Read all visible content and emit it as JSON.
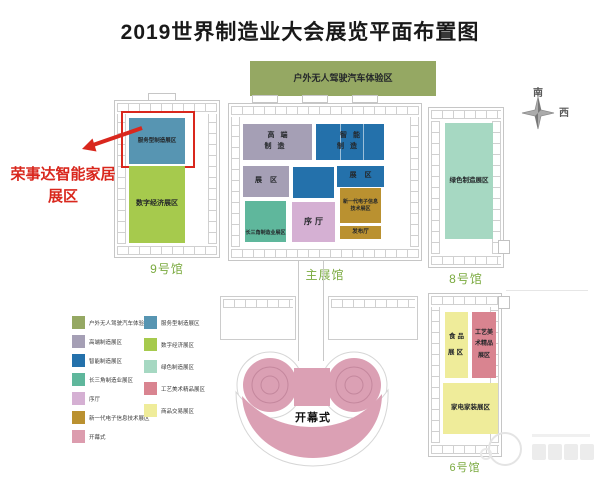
{
  "title": "2019世界制造业大会展览平面布置图",
  "compass": {
    "south": "南",
    "west": "西"
  },
  "callout": {
    "line1": "荣事达智能家居",
    "line2": "展区",
    "color": "#d9271d"
  },
  "halls": {
    "hall9": "9号馆",
    "main": "主展馆",
    "hall8": "8号馆",
    "hall6": "6号馆"
  },
  "zones": {
    "outdoor": {
      "label": "户外无人驾驶汽车体验区",
      "color": "#95a863"
    },
    "service": {
      "label": "服务型制造展区",
      "color": "#5795b2"
    },
    "digital": {
      "label": "数字经济展区",
      "color": "#a6ca4d"
    },
    "highend": {
      "label": "高端\n制造",
      "color": "#a59fb5"
    },
    "highend_area": {
      "label": "展区",
      "color": "#a59fb5"
    },
    "smart": {
      "label": "智能\n制造",
      "color": "#2471ab"
    },
    "smart_area": {
      "label": "展区",
      "color": "#2471ab"
    },
    "delta": {
      "label": "长三角制造业展区",
      "color": "#5fb79c"
    },
    "atrium": {
      "label": "序厅",
      "color": "#d5b0d3"
    },
    "nextgen": {
      "label": "新一代电子信息技术展区",
      "color": "#ba9130"
    },
    "release": {
      "label": "发布厅",
      "color": "#ba9130"
    },
    "green": {
      "label": "绿色制造展区",
      "color": "#a6d8c2"
    },
    "food": {
      "label": "食品\n展区",
      "color": "#efec9a"
    },
    "crafts": {
      "label": "工艺美\n术精品\n展区",
      "color": "#d98490"
    },
    "appliance": {
      "label": "家电家装展区",
      "color": "#efec9a"
    },
    "ceremony": {
      "label": "开幕式",
      "color": "#dba0b4"
    }
  },
  "legend": {
    "left": [
      {
        "label": "户外无人驾驶汽车体验区",
        "color": "#95a863"
      },
      {
        "label": "高端制造展区",
        "color": "#a59fb5"
      },
      {
        "label": "智能制造展区",
        "color": "#2471ab"
      },
      {
        "label": "长三角制造业展区",
        "color": "#5fb79c"
      },
      {
        "label": "序厅",
        "color": "#d5b0d3"
      },
      {
        "label": "新一代电子信息技术展区",
        "color": "#ba9130"
      },
      {
        "label": "开幕式",
        "color": "#dc9cae"
      }
    ],
    "right": [
      {
        "label": "服务型制造展区",
        "color": "#5795b2"
      },
      {
        "label": "数字经济展区",
        "color": "#a6ca4d"
      },
      {
        "label": "绿色制造展区",
        "color": "#a6d8c2"
      },
      {
        "label": "工艺美术精品展区",
        "color": "#d98490"
      },
      {
        "label": "商品交易展区",
        "color": "#efec9a"
      }
    ]
  }
}
